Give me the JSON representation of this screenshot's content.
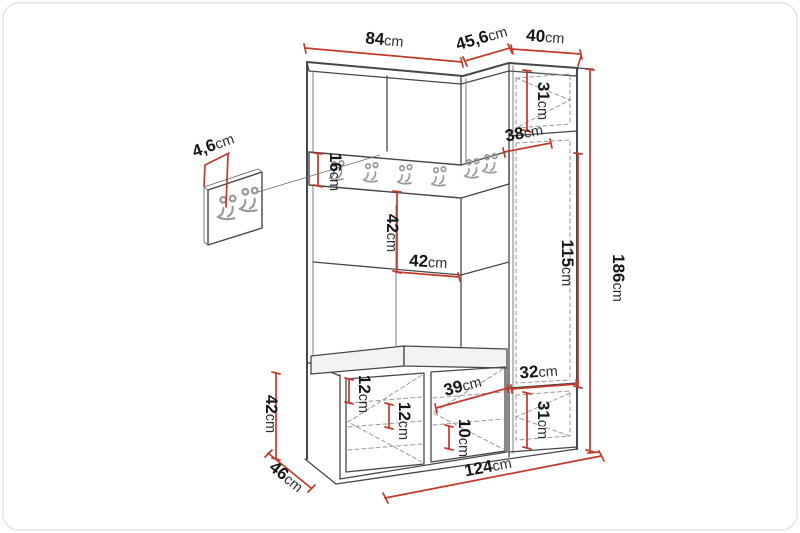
{
  "title": "Hallway furniture set — dimensional diagram",
  "colors": {
    "dim": "#c13a2c",
    "outline": "#474747",
    "dashed": "#9a9a9a",
    "hook": "#9a9a9a",
    "cushion": "#f3f3f3",
    "text": "#161616"
  },
  "dims": {
    "top_main": "84cm",
    "top_corner": "45,6cm",
    "top_right": "40cm",
    "panel_thickness": "4,6cm",
    "rail_height": "16cm",
    "mid_height": "42cm",
    "mid_width": "42cm",
    "corner_depth": "38cm",
    "right_top": "31cm",
    "right_door": "115cm",
    "total_height": "186cm",
    "right_width": "32cm",
    "right_bottom": "31cm",
    "bench_upper": "12cm",
    "bench_lower": "12cm",
    "bench_door": "39cm",
    "bench_shelf": "10cm",
    "bench_height": "42cm",
    "depth": "46cm",
    "total_width": "124cm"
  }
}
